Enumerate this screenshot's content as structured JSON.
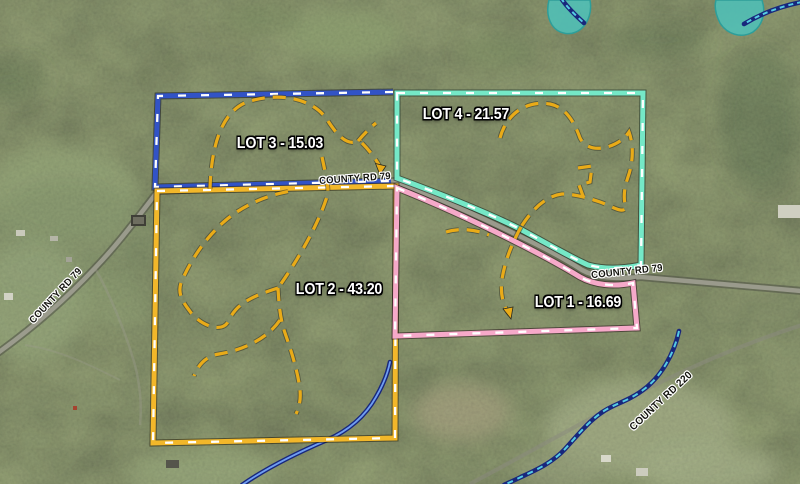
{
  "map": {
    "kind": "aerial-plat-map",
    "units": "acres"
  },
  "lots": [
    {
      "id": "lot-1",
      "name": "LOT 1",
      "acreage": "16.69",
      "label": "LOT 1 - 16.69",
      "border_color": "#f6a9c9"
    },
    {
      "id": "lot-2",
      "name": "LOT 2",
      "acreage": "43.20",
      "label": "LOT 2 - 43.20",
      "border_color": "#f2b72a"
    },
    {
      "id": "lot-3",
      "name": "LOT 3",
      "acreage": "15.03",
      "label": "LOT 3 - 15.03",
      "border_color": "#3253c6"
    },
    {
      "id": "lot-4",
      "name": "LOT 4",
      "acreage": "21.57",
      "label": "LOT 4 - 21.57",
      "border_color": "#75e8c7"
    }
  ],
  "roads": [
    {
      "id": "county-rd-79-west",
      "text": "COUNTY RD 79"
    },
    {
      "id": "county-rd-79-mid",
      "text": "COUNTY RD 79"
    },
    {
      "id": "county-rd-79-east",
      "text": "COUNTY RD 79"
    },
    {
      "id": "county-rd-220",
      "text": "COUNTY RD 220"
    }
  ],
  "features": {
    "trail_color": "#e9ab18",
    "boundary_tick_color": "#ffffff",
    "creek_outline_color": "#18277c",
    "creek_center_color": "#6f9ef2",
    "creek_dash_color": "#55cbe4",
    "pond_color": "#4fc0b8",
    "road_color": "#a3a396"
  }
}
